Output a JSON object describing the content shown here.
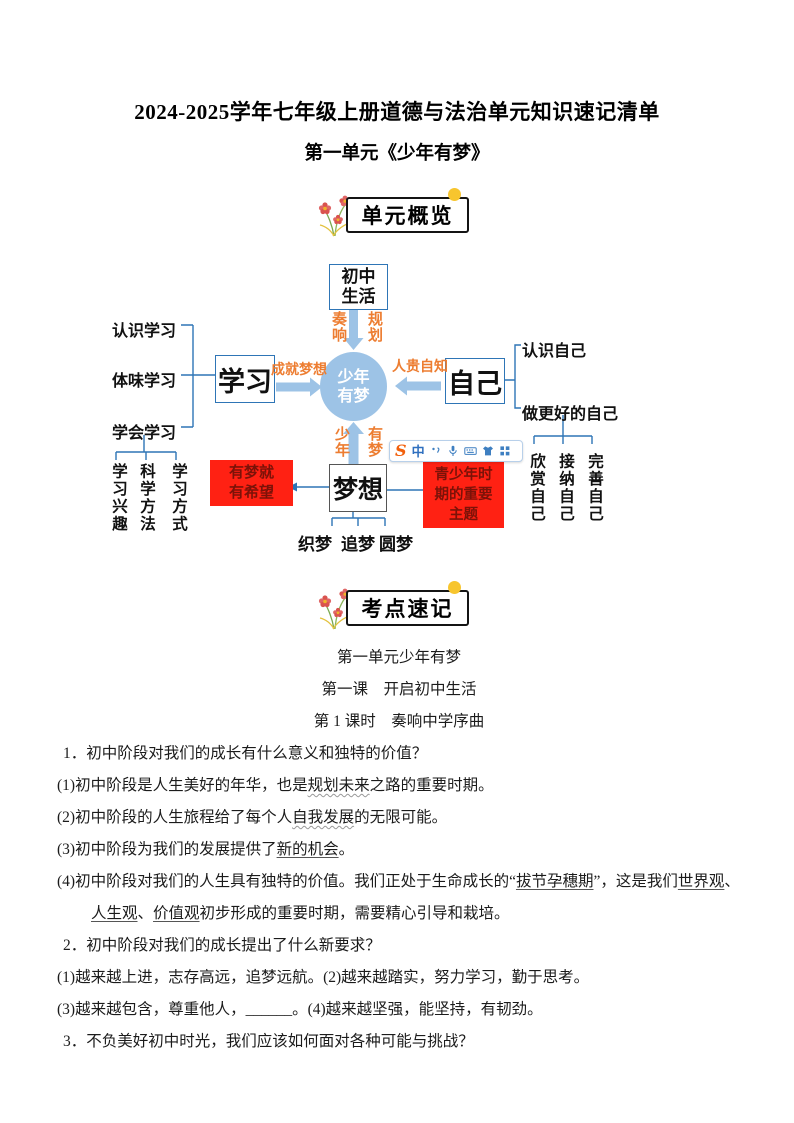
{
  "page": {
    "title": "2024-2025学年七年级上册道德与法治单元知识速记清单",
    "subtitle": "第一单元《少年有梦》"
  },
  "badges": {
    "overview": "单元概览",
    "keypoints": "考点速记"
  },
  "mindmap": {
    "colors": {
      "node_fill": "#9DC3E6",
      "line_blue": "#2E75B6",
      "orange": "#ED7D31",
      "red_box_bg": "#FF2113",
      "red_box_text": "#7B1208"
    },
    "center": {
      "line1": "少年",
      "line2": "有梦"
    },
    "top": {
      "box_line1": "初中",
      "box_line2": "生活",
      "label_left": "奏响",
      "label_right": "规划"
    },
    "left": {
      "box": "学习",
      "arrow_label": "成就梦想",
      "items": [
        "认识学习",
        "体味学习",
        "学会学习"
      ],
      "subitems": [
        "学习兴趣",
        "科学方法",
        "学习方式"
      ]
    },
    "right": {
      "box": "自己",
      "arrow_label": "人贵自知",
      "items": [
        "认识自己",
        "做更好的自己"
      ],
      "subitems": [
        "欣赏自己",
        "接纳自己",
        "完善自己"
      ]
    },
    "bottom": {
      "box": "梦想",
      "label_left": "少年",
      "label_right": "有梦",
      "red_left": {
        "line1": "有梦就",
        "line2": "有希望"
      },
      "red_right": {
        "line1": "青少年时",
        "line2": "期的重要",
        "line3": "主题"
      },
      "items": [
        "织梦",
        "追梦",
        "圆梦"
      ]
    }
  },
  "ime_toolbar": {
    "logo": "S",
    "mode": "中",
    "icon_names": [
      "punctuation",
      "microphone",
      "keyboard",
      "skin",
      "toolbox"
    ]
  },
  "notes": {
    "heading1": "第一单元少年有梦",
    "heading2": "第一课　开启初中生活",
    "heading3": "第 1 课时　奏响中学序曲",
    "q1": "1．初中阶段对我们的成长有什么意义和独特的价值？",
    "a1": {
      "s0": "(1)初中阶段是人生美好的年华，也是",
      "u1": "规划未来",
      "s1": "之路的重要时期。"
    },
    "a2": {
      "s0": "(2)初中阶段的人生旅程给了每个人",
      "u1": "自我发展",
      "s1": "的无限可能。"
    },
    "a3": {
      "s0": "(3)初中阶段为我们的发展提供了",
      "u1": "新的机会",
      "s1": "。"
    },
    "a4a": {
      "s0": "(4)初中阶段对我们的人生具有独特的价值。我们正处于生命成长的“",
      "u1": "拔节孕穗期",
      "s1": "”，这是我们",
      "u2": "世界观",
      "s2": "、"
    },
    "a4b": {
      "u1": "人生观",
      "s1": "、",
      "u2": "价值观",
      "s2": "初步形成的重要时期，需要精心引导和栽培。"
    },
    "q2": "2．初中阶段对我们的成长提出了什么新要求？",
    "a5": "(1)越来越上进，志存高远，追梦远航。(2)越来越踏实，努力学习，勤于思考。",
    "a6": "(3)越来越包含，尊重他人，______。(4)越来越坚强，能坚持，有韧劲。",
    "q3": "3．不负美好初中时光，我们应该如何面对各种可能与挑战？"
  }
}
